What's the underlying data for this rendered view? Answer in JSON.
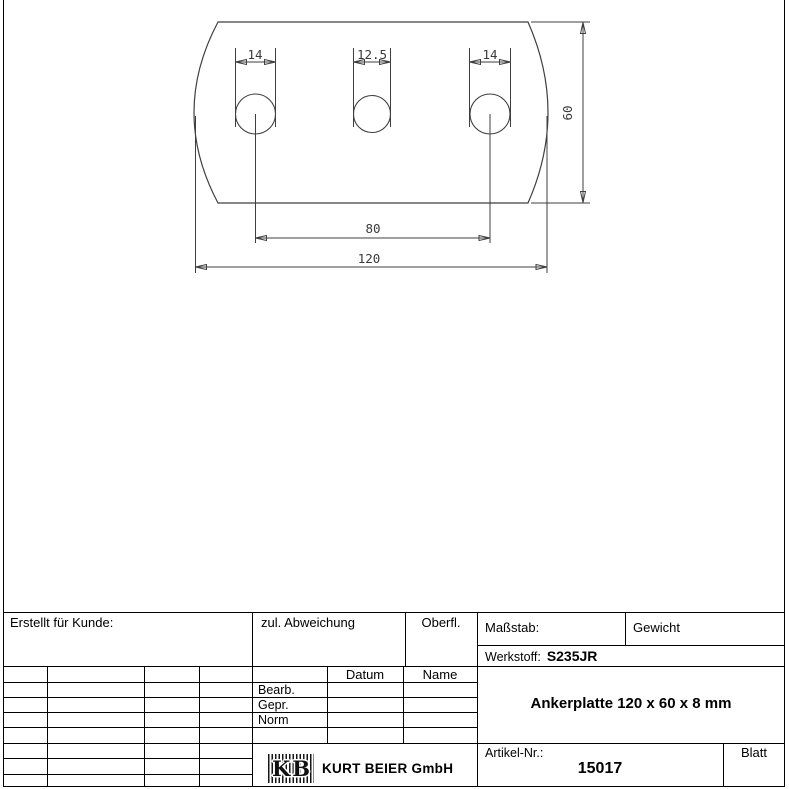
{
  "drawing": {
    "dim_hole_left": "14",
    "dim_hole_middle": "12.5",
    "dim_hole_right": "14",
    "dim_height": "60",
    "dim_hole_spacing": "80",
    "dim_width": "120"
  },
  "title_block": {
    "erstellt_label": "Erstellt für Kunde:",
    "abweichung_label": "zul. Abweichung",
    "oberfl_label": "Oberfl.",
    "massstab_label": "Maßstab:",
    "gewicht_label": "Gewicht",
    "werkstoff_label": "Werkstoff:",
    "werkstoff_value": "S235JR",
    "datum_header": "Datum",
    "name_header": "Name",
    "row_bearb": "Bearb.",
    "row_gepr": "Gepr.",
    "row_norm": "Norm",
    "part_title": "Ankerplatte 120 x 60 x 8 mm",
    "artikel_label": "Artikel-Nr.:",
    "artikel_value": "15017",
    "blatt_label": "Blatt",
    "company_name": "KURT BEIER GmbH",
    "logo_letter_k": "K",
    "logo_letter_b": "B"
  },
  "colors": {
    "frame_line": "#000000",
    "drawing_line": "#3f3f3f",
    "text": "#000000"
  }
}
